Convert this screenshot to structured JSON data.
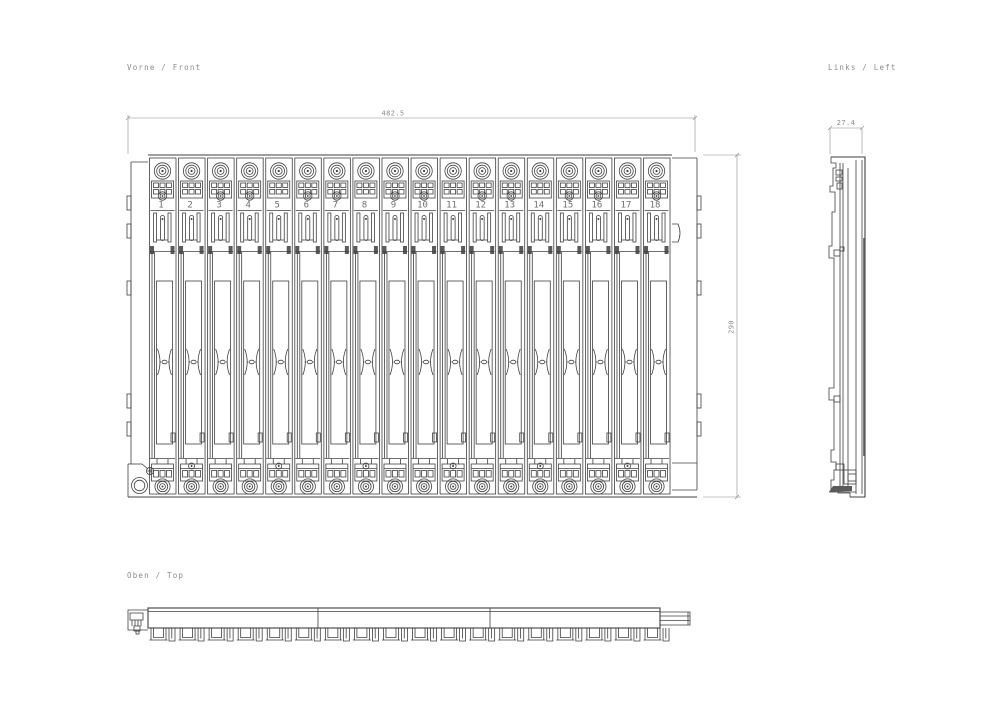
{
  "views": {
    "front": {
      "label": "Vorne / Front"
    },
    "left": {
      "label": "Links / Left"
    },
    "top": {
      "label": "Oben / Top"
    }
  },
  "dimensions": {
    "front_width": "482.5",
    "front_height": "290",
    "side_depth": "27.4"
  },
  "slots": {
    "numbers": [
      "1",
      "2",
      "3",
      "4",
      "5",
      "6",
      "7",
      "8",
      "9",
      "10",
      "11",
      "12",
      "13",
      "14",
      "15",
      "16",
      "17",
      "18"
    ]
  },
  "colors": {
    "line": "#3f3f3f",
    "dim_line": "#8c8c8c",
    "dim_text": "#8a8a8a",
    "slot_number_text": "#6e6e6e",
    "background": "#ffffff"
  }
}
